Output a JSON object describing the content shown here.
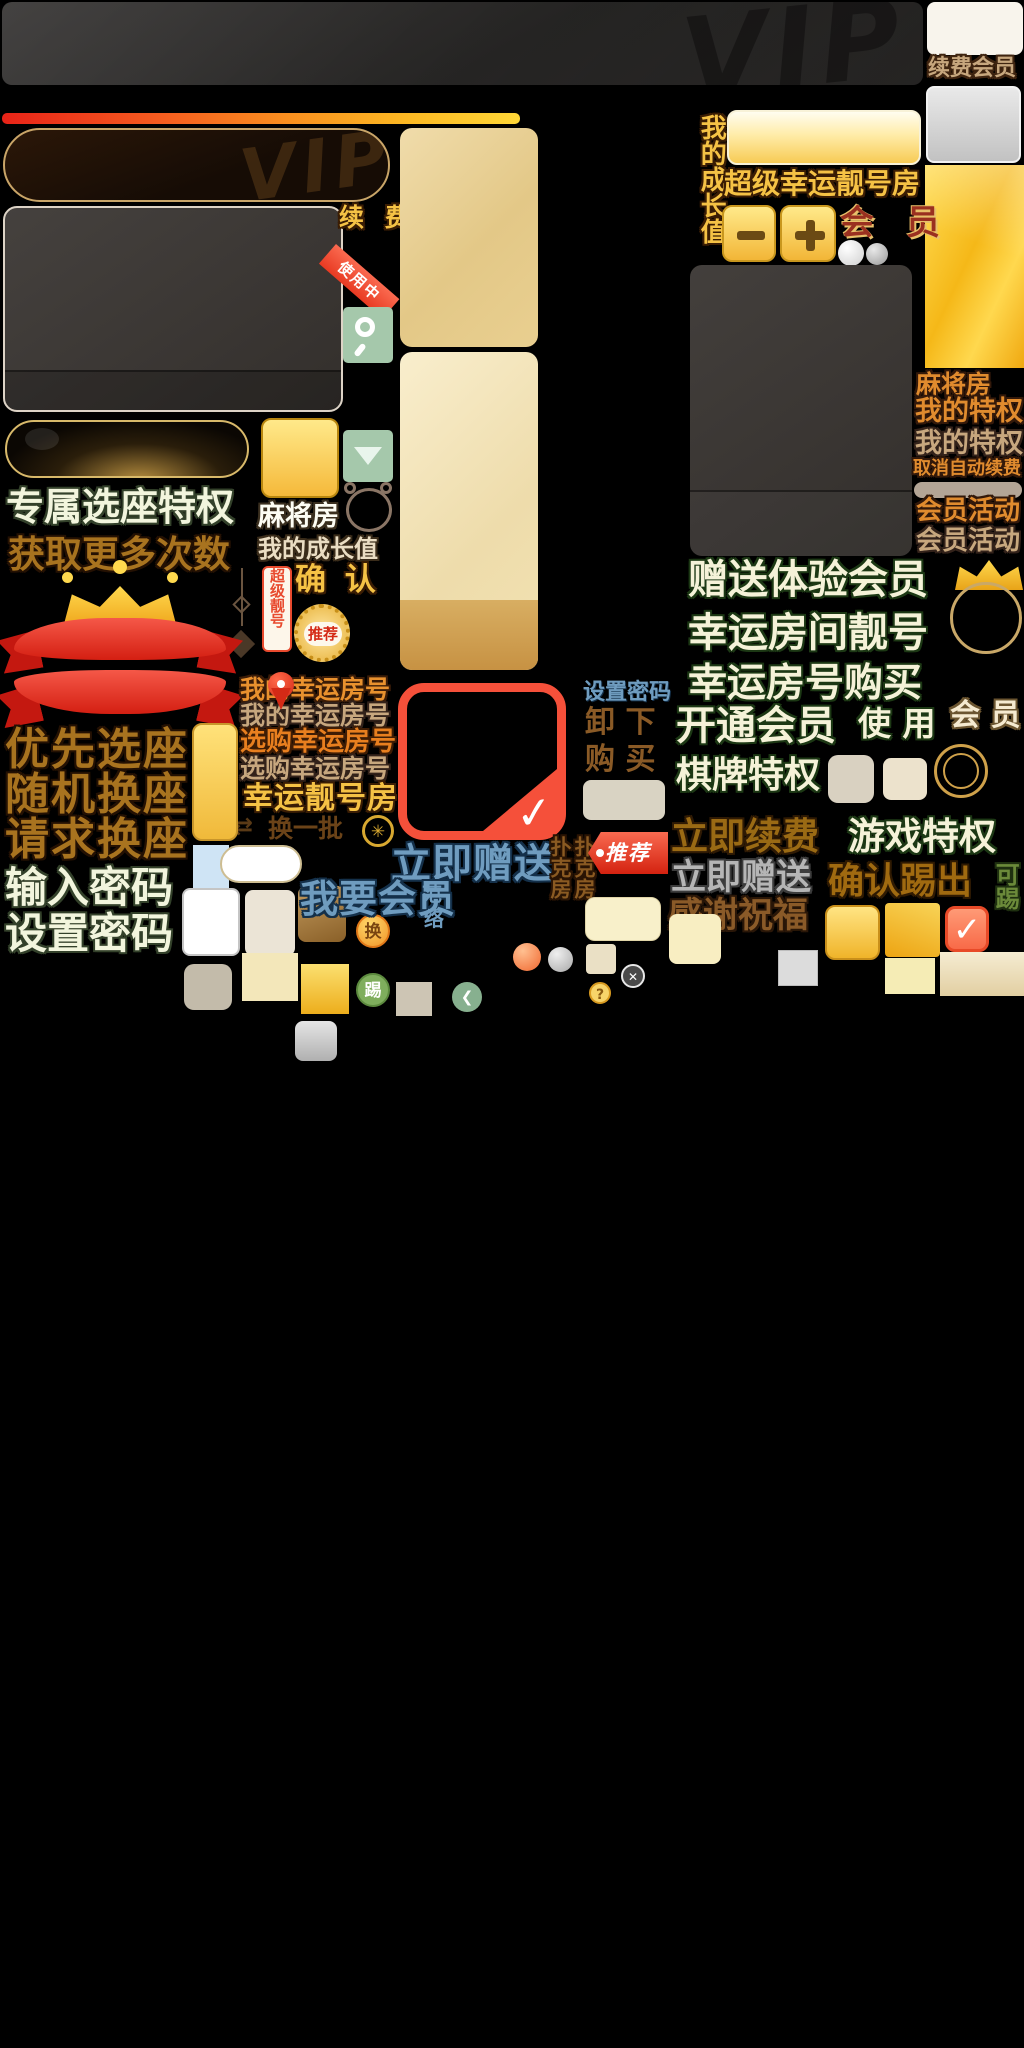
{
  "meta": {
    "kind": "game-ui-sprite-atlas",
    "theme": "VIP membership / mahjong & poker room assets"
  },
  "colors": {
    "background": "#000000",
    "gold_accent": "#f5c245",
    "red_accent": "#f5503a",
    "green_text_fill": "#f5f2d8",
    "green_text_outline": "#1c3814",
    "brown_text": "#a8731f",
    "blue_text": "#6f9cbf",
    "gradient_bar": [
      "#e82318",
      "#f55b1f",
      "#f98f1f",
      "#fcb823",
      "#ffd737"
    ],
    "sage_green_button": "#a5c8ab",
    "panel_gold": "#e9d09a",
    "dark_card": "#3b3734"
  },
  "labels": {
    "vip_watermark": "VIP",
    "renew_member": "续费会员",
    "my_growth_vertical": "我的成长值",
    "super_lucky_room": "超级幸运靓号房",
    "member_red": "会 员",
    "renew": "续 费",
    "in_use": "使用中",
    "mahjong_room_mid": "麻将房",
    "my_growth_mid": "我的成长值",
    "super_nice_tag": "超级靓号",
    "confirm": "确 认",
    "recommend_medal": "推荐",
    "exclusive_seat": "专属选座特权",
    "get_more_times": "获取更多次数",
    "priority_seat": "优先选座",
    "random_swap_seat": "随机换座",
    "request_swap_seat": "请求换座",
    "enter_password": "输入密码",
    "set_password_big": "设置密码",
    "my_lucky_room_1": "我的幸运房号",
    "my_lucky_room_2": "我的幸运房号",
    "buy_lucky_room_1": "选购幸运房号",
    "buy_lucky_room_2": "选购幸运房号",
    "lucky_nice_room": "幸运靓号房",
    "change_batch": "换一批",
    "set_password_small": "设置密码",
    "unload": "卸  下",
    "purchase": "购  买",
    "give_now_blue": "立即赠送",
    "want_member": "我要会员",
    "fan": "范",
    "luo": "络",
    "poker_room_1": "扑克房",
    "poker_room_2": "扑克房",
    "recommend_tag": "推荐",
    "renew_now": "立即续费",
    "give_now_gray": "立即赠送",
    "thanks_blessing": "感谢祝福",
    "mahjong_room_right": "麻将房",
    "my_privilege_1": "我的特权",
    "my_privilege_2": "我的特权",
    "cancel_auto_renew": "取消自动续费",
    "member_activity_1": "会员活动",
    "member_activity_2": "会员活动",
    "gift_trial_member": "赠送体验会员",
    "lucky_room_number": "幸运房间靓号",
    "lucky_number_buy": "幸运房号购买",
    "open_member": "开通会员",
    "use_spaced": "使  用",
    "member_spaced_2": "会  员",
    "chess_privilege": "棋牌特权",
    "game_privilege": "游戏特权",
    "confirm_kick": "确认踢出",
    "kickable": "可踢",
    "swap_coin": "换",
    "kick_coin": "踢",
    "question_coin": "?"
  },
  "icons": {
    "refresh": "⇄",
    "back_chevron": "❮",
    "close_x": "✕",
    "check": "✓",
    "wheat": "✳",
    "minus": "▬"
  }
}
